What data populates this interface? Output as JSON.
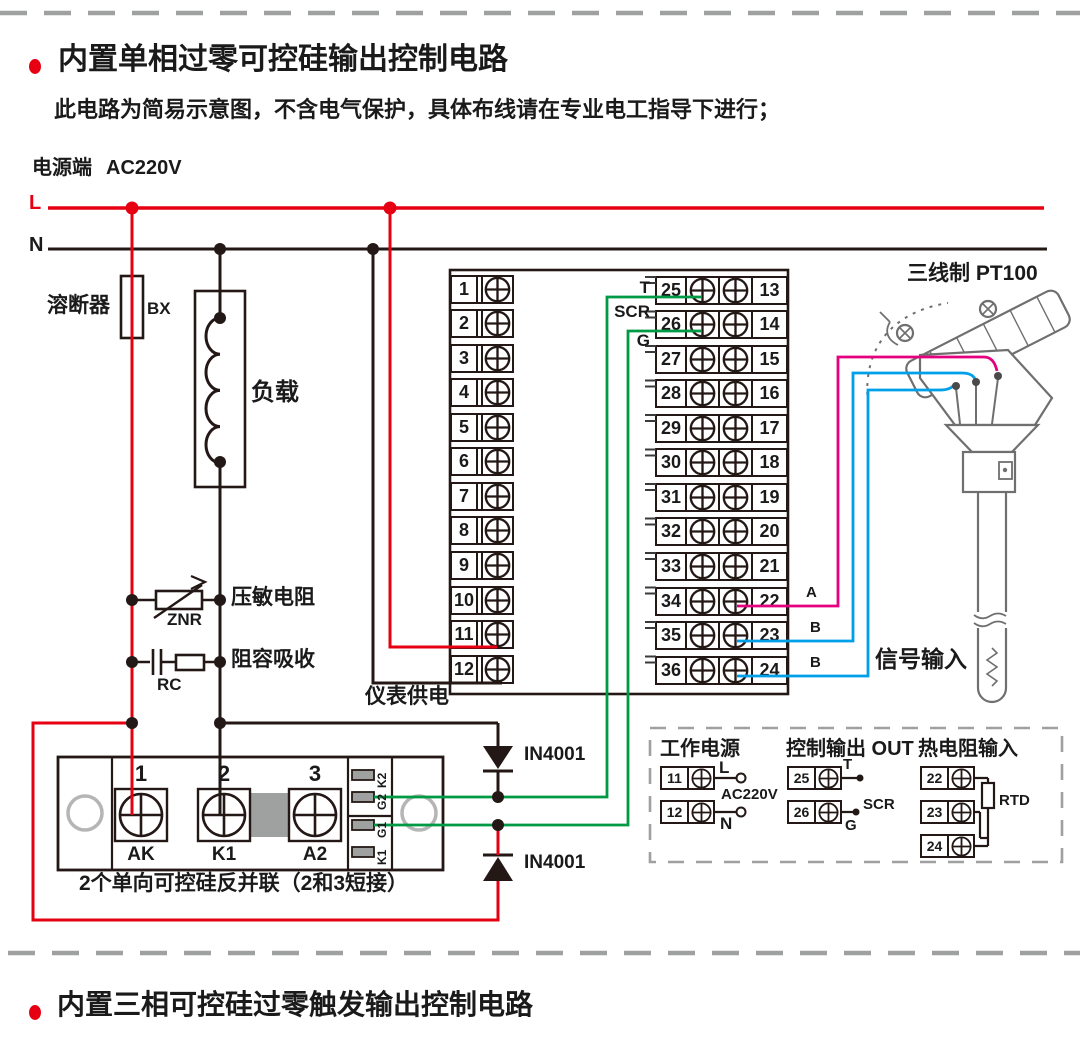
{
  "section1": {
    "title": "内置单相过零可控硅输出控制电路",
    "note": "此电路为简易示意图，不含电气保护，具体布线请在专业电工指导下进行；"
  },
  "section2": {
    "title": "内置三相可控硅过零触发输出控制电路"
  },
  "power": {
    "terminal_label": "电源端",
    "voltage": "AC220V",
    "l": "L",
    "n": "N"
  },
  "fuse": {
    "label": "溶断器",
    "code": "BX"
  },
  "load": {
    "label": "负载"
  },
  "varistor": {
    "label": "压敏电阻",
    "code": "ZNR"
  },
  "rc": {
    "label": "阻容吸收",
    "code": "RC"
  },
  "instrument": {
    "supply_label": "仪表供电",
    "t": "T",
    "scr": "SCR",
    "g": "G",
    "left_terminals": [
      "1",
      "2",
      "3",
      "4",
      "5",
      "6",
      "7",
      "8",
      "9",
      "10",
      "11",
      "12"
    ],
    "inner_terminals": [
      "25",
      "26",
      "27",
      "28",
      "29",
      "30",
      "31",
      "32",
      "33",
      "34",
      "35",
      "36"
    ],
    "outer_terminals": [
      "13",
      "14",
      "15",
      "16",
      "17",
      "18",
      "19",
      "20",
      "21",
      "22",
      "23",
      "24"
    ]
  },
  "diodes": {
    "d1": "IN4001",
    "d2": "IN4001"
  },
  "module": {
    "numbers": [
      "1",
      "2",
      "3"
    ],
    "names": [
      "AK",
      "K1",
      "A2"
    ],
    "gates": [
      "K2",
      "G2",
      "G1",
      "K1"
    ],
    "caption": "2个单向可控硅反并联（2和3短接）"
  },
  "sensor": {
    "title": "三线制 PT100",
    "a": "A",
    "b1": "B",
    "b2": "B",
    "signal": "信号输入"
  },
  "legend": {
    "g1": {
      "title": "工作电源",
      "t1": "11",
      "t2": "12",
      "l": "L",
      "voltage": "AC220V",
      "n": "N"
    },
    "g2": {
      "title": "控制输出 OUT",
      "t1": "25",
      "t2": "26",
      "t": "T",
      "scr": "SCR",
      "g": "G"
    },
    "g3": {
      "title": "热电阻输入",
      "t1": "22",
      "t2": "23",
      "t3": "24",
      "rtd": "RTD"
    }
  },
  "colors": {
    "red": "#e60012",
    "green": "#009944",
    "pink": "#e4007f",
    "blue": "#00a0e9",
    "line": "#231815",
    "gray": "#9fa0a0"
  }
}
